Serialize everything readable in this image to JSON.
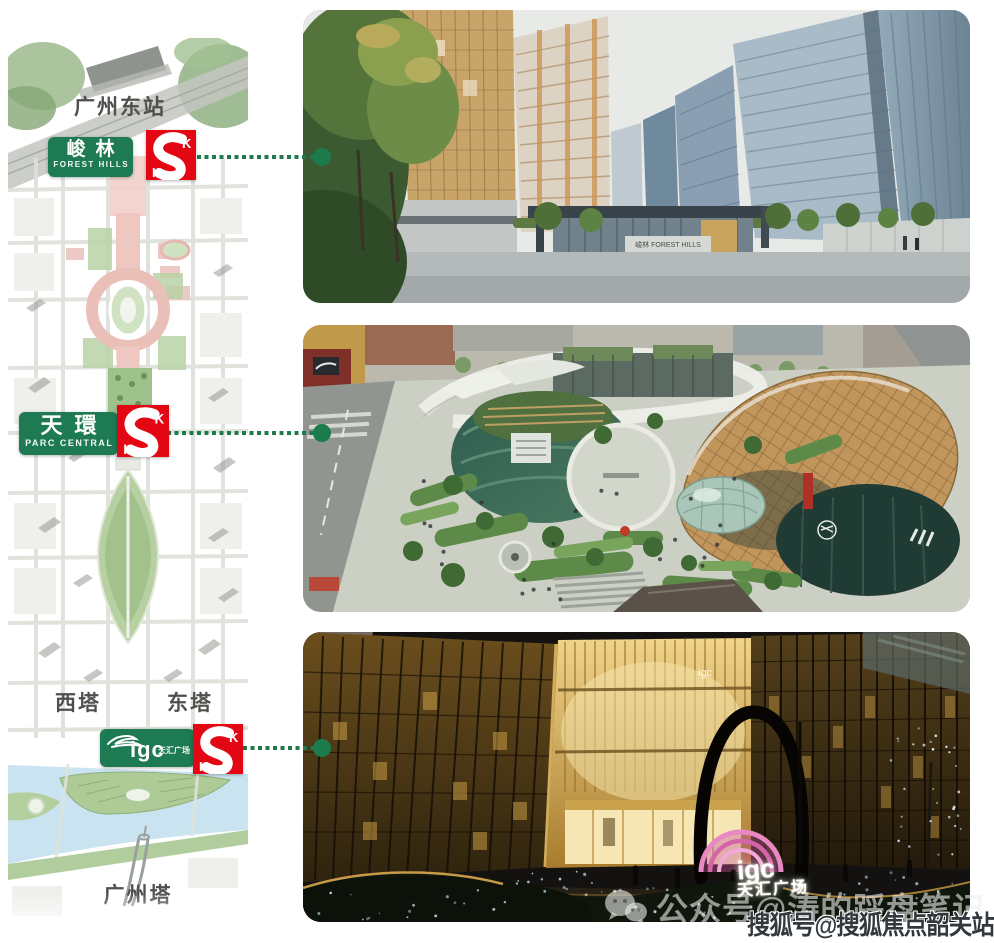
{
  "page": {
    "background": "#ffffff"
  },
  "colors": {
    "badge_green": "#1d7a53",
    "logo_red": "#e30613",
    "connector_green": "#1d7a4c",
    "map_label_gray": "#4f4f4d",
    "river_blue": "#c9e4f0",
    "park_green": "#b7d0a2",
    "axis_pink": "#eec7c1"
  },
  "map": {
    "area_labels": [
      {
        "id": "gz-east-station",
        "text": "广州东站"
      },
      {
        "id": "west-tower",
        "text": "西塔"
      },
      {
        "id": "east-tower",
        "text": "东塔"
      },
      {
        "id": "canton-tower",
        "text": "广州塔"
      }
    ],
    "badges": [
      {
        "id": "forest-hills",
        "title": "峻林",
        "subtitle": "FOREST HILLS"
      },
      {
        "id": "parc-central",
        "title": "天環",
        "subtitle": "PARC CENTRAL"
      },
      {
        "id": "igc",
        "title": "igc",
        "subtitle": "天汇广场"
      }
    ],
    "developer_logo": {
      "s": "S",
      "k": "K",
      "h": "H"
    }
  },
  "photos": [
    {
      "id": "forest-hills",
      "gate_sign": "峻林 FOREST HILLS"
    },
    {
      "id": "parc-central"
    },
    {
      "id": "igc",
      "facade_sign": "igc"
    }
  ],
  "igc_sign": {
    "line1": "igc",
    "line2": "天汇广场"
  },
  "watermarks": {
    "wechat": "公众号@涛的踩盘笔记",
    "sohu": "搜狐号@搜狐焦点韶关站"
  }
}
